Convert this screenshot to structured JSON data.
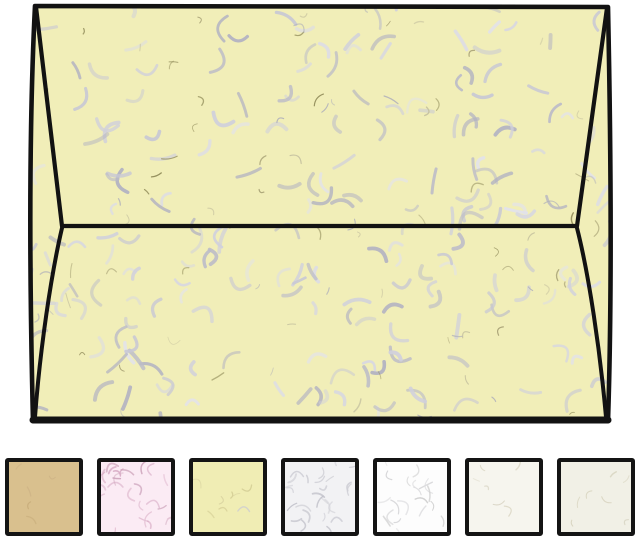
{
  "product_image": {
    "background": "#ffffff",
    "envelope": {
      "paper_color": "#f1eeb8",
      "outline_color": "#121212",
      "texture": {
        "squiggles": {
          "seed": 7,
          "count": 150,
          "len": [
            12,
            26
          ],
          "width": [
            2.6,
            4.0
          ],
          "colors": [
            "#bcbcc8",
            "#c8c8d4",
            "#b2b2c2",
            "#d0d0dc"
          ]
        },
        "highlights": {
          "seed": 41,
          "count": 60,
          "len": [
            10,
            22
          ],
          "width": [
            2.4,
            3.6
          ],
          "colors": [
            "#dcdce6",
            "#e2e2ea",
            "#d6d6e2"
          ]
        },
        "fibers": {
          "seed": 99,
          "count": 80,
          "len": [
            5,
            16
          ],
          "width": [
            0.8,
            1.4
          ],
          "colors": [
            "#8f8a58",
            "#a8a276",
            "#b2b2ba",
            "#c6c2a0"
          ]
        }
      }
    }
  },
  "swatches": [
    {
      "name": "tan",
      "bg": "#d9c08e",
      "count": 5,
      "len": [
        5,
        12
      ],
      "width": [
        0.9,
        1.4
      ],
      "colors": [
        "#c7ab7a",
        "#ccb184"
      ]
    },
    {
      "name": "pink",
      "bg": "#fbebf4",
      "count": 26,
      "len": [
        7,
        16
      ],
      "width": [
        1.2,
        1.8
      ],
      "colors": [
        "#d9aec7",
        "#cfa6bd",
        "#e3bfd3"
      ]
    },
    {
      "name": "yellow",
      "bg": "#f0edb4",
      "count": 8,
      "len": [
        5,
        13
      ],
      "width": [
        1.0,
        1.6
      ],
      "colors": [
        "#d8d2a0",
        "#c9c9d4",
        "#cfc890"
      ]
    },
    {
      "name": "gray",
      "bg": "#f2f2f4",
      "count": 26,
      "len": [
        7,
        16
      ],
      "width": [
        1.2,
        1.8
      ],
      "colors": [
        "#c4c4cc",
        "#cfcfd6",
        "#bcbcc6"
      ]
    },
    {
      "name": "white",
      "bg": "#fdfdfd",
      "count": 20,
      "len": [
        7,
        16
      ],
      "width": [
        1.0,
        1.6
      ],
      "colors": [
        "#d6d6d8",
        "#dedee0",
        "#cecece"
      ]
    },
    {
      "name": "ivory",
      "bg": "#f6f5ee",
      "count": 6,
      "len": [
        5,
        12
      ],
      "width": [
        0.9,
        1.4
      ],
      "colors": [
        "#dcd8c6",
        "#d4d0be"
      ]
    },
    {
      "name": "natural",
      "bg": "#f1f0e6",
      "count": 7,
      "len": [
        5,
        12
      ],
      "width": [
        0.9,
        1.4
      ],
      "colors": [
        "#d6d2bd",
        "#ccc8b2"
      ]
    }
  ]
}
